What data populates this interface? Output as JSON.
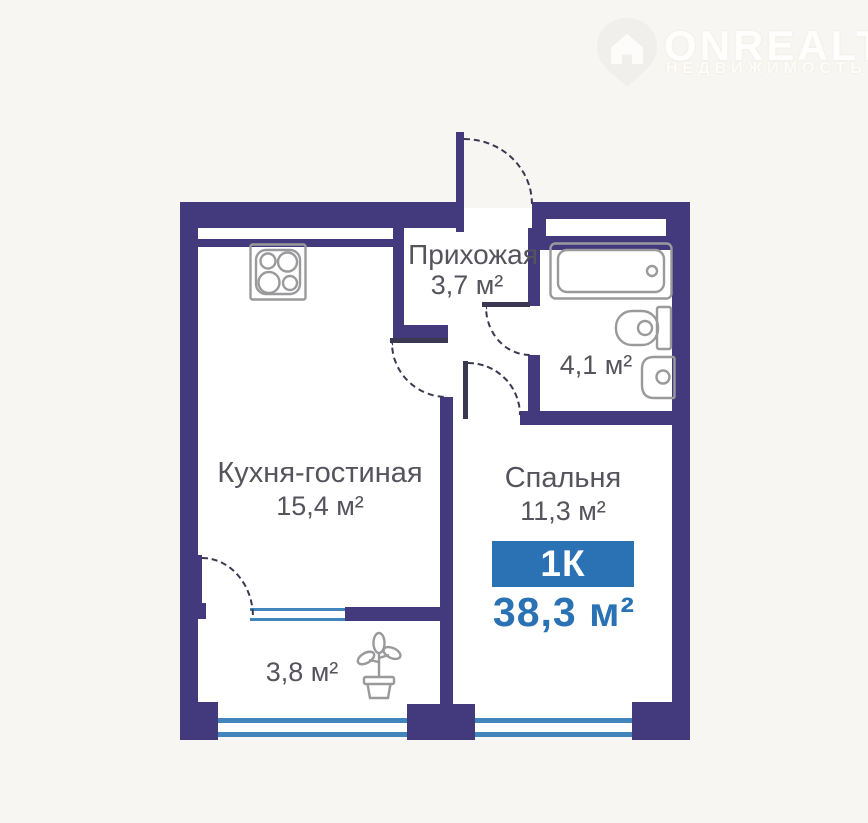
{
  "page": {
    "background": "#f8f6f2",
    "plan_floor": "#ffffff"
  },
  "logo": {
    "brand": "ONREALT",
    "tagline": "НЕДВИЖИМОСТЬ"
  },
  "plan": {
    "colors": {
      "wall": "#423a7c",
      "accent": "#2a72b4",
      "glaze": "#4285bd",
      "fixture": "#9a999b",
      "label": "#55545d",
      "door": "#3a3850"
    },
    "rooms": {
      "hallway": {
        "name": "Прихожая",
        "area": "3,7 м²"
      },
      "bathroom": {
        "area": "4,1 м²"
      },
      "kitchen_living": {
        "name": "Кухня-гостиная",
        "area": "15,4 м²"
      },
      "bedroom": {
        "name": "Спальня",
        "area": "11,3 м²"
      },
      "balcony": {
        "area": "3,8 м²"
      }
    },
    "summary": {
      "rooms_badge": "1К",
      "total_area": "38,3 м²"
    },
    "icons": [
      "location-pin-logo-icon",
      "stove-hob-icon",
      "bathtub-icon",
      "toilet-icon",
      "sink-icon",
      "plant-icon"
    ]
  }
}
